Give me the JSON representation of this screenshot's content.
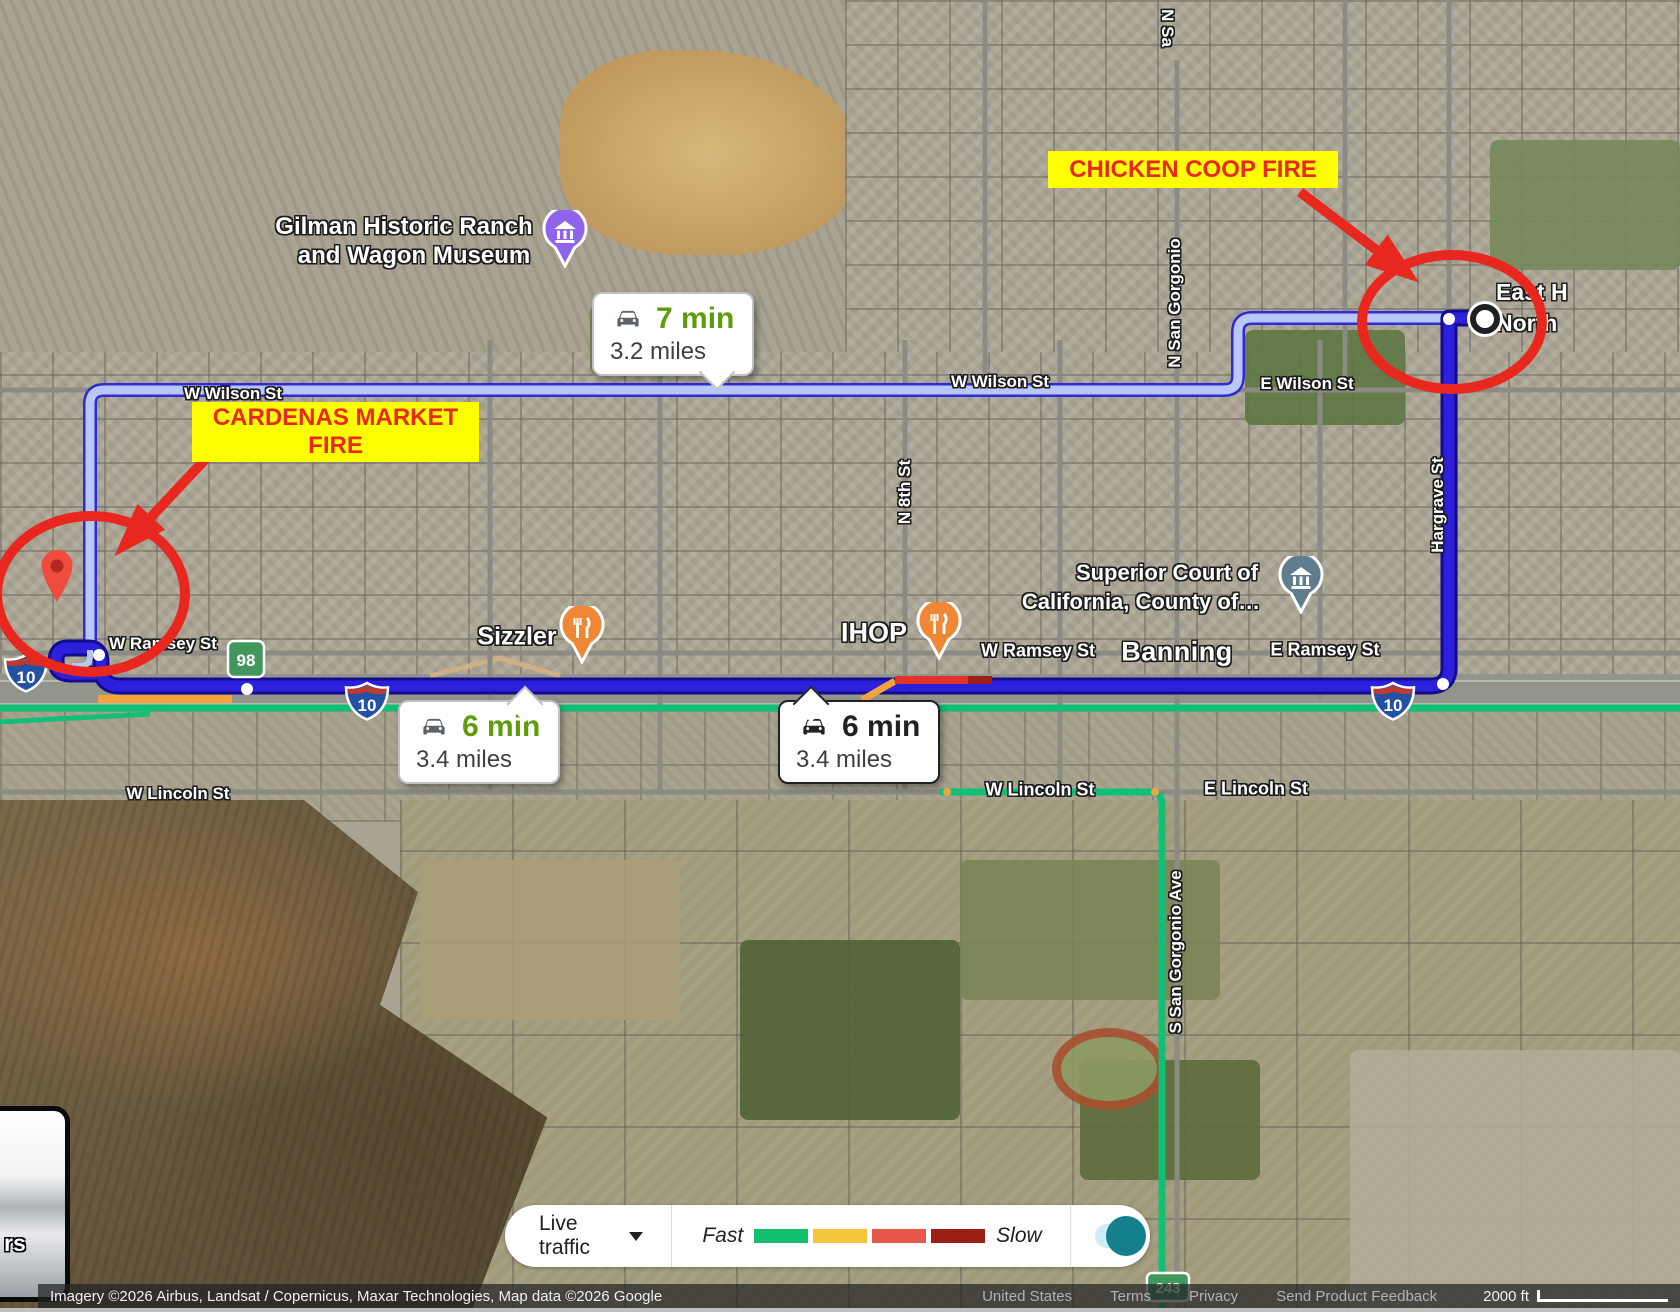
{
  "annotations": {
    "chicken_coop": "CHICKEN COOP FIRE",
    "cardenas_line1": "CARDENAS MARKET",
    "cardenas_line2": "FIRE"
  },
  "badges": {
    "wilson": {
      "time": "7 min",
      "distance": "3.2 miles"
    },
    "i10_west": {
      "time": "6 min",
      "distance": "3.4 miles"
    },
    "i10_mid": {
      "time": "6 min",
      "distance": "3.4 miles"
    }
  },
  "pois": {
    "museum_line1": "Gilman Historic Ranch",
    "museum_line2": "and Wagon Museum",
    "sizzler": "Sizzler",
    "ihop": "IHOP",
    "court_line1": "Superior Court of",
    "court_line2": "California, County of…",
    "city": "Banning",
    "dest_line1": "East H",
    "dest_line2": "North"
  },
  "streets": {
    "w_wilson_a": "W Wilson St",
    "w_wilson_b": "W Wilson St",
    "e_wilson": "E Wilson St",
    "w_ramsey_a": "W Ramsey St",
    "w_ramsey_b": "W Ramsey St",
    "e_ramsey": "E Ramsey St",
    "w_lincoln_a": "W Lincoln St",
    "w_lincoln_b": "W Lincoln St",
    "e_lincoln": "E Lincoln St",
    "n_sa_partial": "N Sa",
    "n_san_gorgonio": "N San Gorgonio",
    "n_8th": "N 8th St",
    "hargrave": "Hargrave St",
    "s_san_gorgonio": "S San Gorgonio Ave"
  },
  "shields": {
    "i10": "10",
    "sr98": "98",
    "sr243": "243"
  },
  "traffic_bar": {
    "live_traffic": "Live traffic",
    "fast": "Fast",
    "slow": "Slow",
    "legend_colors": [
      "#12c06d",
      "#f3c73d",
      "#e8584a",
      "#9c1f15"
    ]
  },
  "attribution": {
    "imagery": "Imagery ©2026 Airbus, Landsat / Copernicus, Maxar Technologies, Map data ©2026 Google",
    "region": "United States",
    "terms": "Terms",
    "privacy": "Privacy",
    "feedback": "Send Product Feedback",
    "scale": "2000 ft"
  },
  "layers_control": {
    "partial_label": "rs"
  },
  "colors": {
    "annotation-red": "#e8281e",
    "annotation-yellow": "#ffff00",
    "route-primary": "#2d20dc",
    "route-primary-border": "#140b8f",
    "route-alt-fill": "#b9c7f7",
    "route-alt-border": "#2f2bd3",
    "traffic-green": "#12bf76",
    "traffic-orange": "#f2a33c",
    "traffic-red": "#df3428",
    "traffic-dark-red": "#9c1f15",
    "time-green": "#5e9c0a",
    "toggle-teal": "#15808d"
  }
}
